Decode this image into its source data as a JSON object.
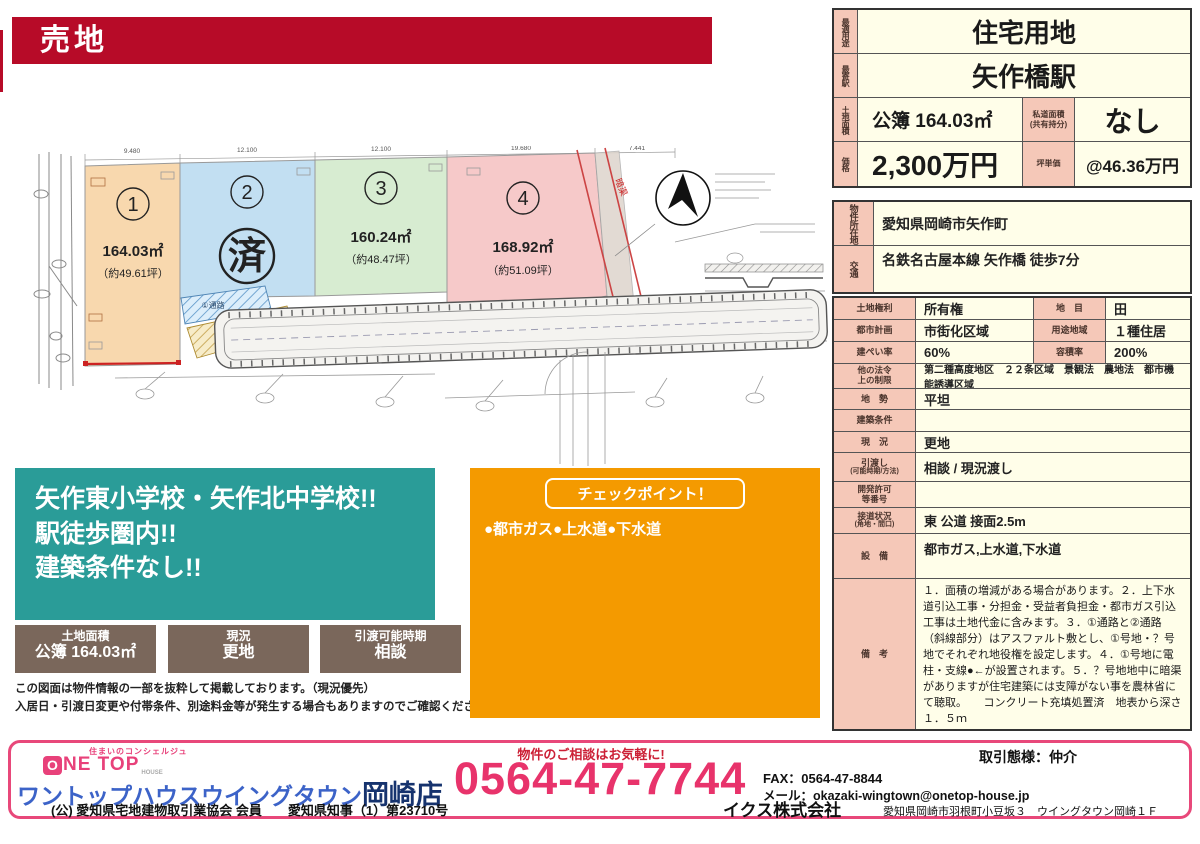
{
  "colors": {
    "banner_red": "#b70b28",
    "teal": "#2a9c98",
    "orange": "#f49a00",
    "brown": "#7a675b",
    "label_pink": "#f5c8b8",
    "cell_ivory": "#fffee9",
    "footer_pink": "#e8487a",
    "phone_pink": "#e8336b",
    "logo_blue": "#3c63c8",
    "logo_navy": "#16336e",
    "lot1": "#f8d8ae",
    "lot2": "#c2dff2",
    "lot3": "#d7ecd1",
    "lot4": "#f6c9c9"
  },
  "banner": {
    "title": "売地"
  },
  "summary": {
    "r1": {
      "label": "最適用途",
      "value": "住宅用地"
    },
    "r2": {
      "label": "最寄駅",
      "value": "矢作橋駅"
    },
    "r3": {
      "label": "土地面積",
      "value": "公簿 164.03㎡",
      "label2": "私道面積",
      "label2_sub": "(共有持分)",
      "value2": "なし"
    },
    "r4": {
      "label": "価格",
      "value": "2,300万円",
      "label2": "坪単価",
      "value2": "@46.36万円"
    }
  },
  "details": {
    "r1": {
      "label": "物件所在地",
      "value": "愛知県岡崎市矢作町"
    },
    "r2": {
      "label": "交通",
      "value": "名鉄名古屋本線 矢作橋 徒歩7分"
    },
    "r3": {
      "label": "土地権利",
      "value": "所有権",
      "label2": "地　目",
      "value2": "田"
    },
    "r4": {
      "label": "都市計画",
      "value": "市街化区域",
      "label2": "用途地域",
      "value2": "１種住居"
    },
    "r5": {
      "label": "建ぺい率",
      "value": "60%",
      "label2": "容積率",
      "value2": "200%"
    },
    "r6": {
      "label": "他の法令",
      "label_sub": "上の制限",
      "value": "第二種高度地区　２２条区域　景観法　農地法　都市機能誘導区域"
    },
    "r7": {
      "label": "地　勢",
      "value": "平坦"
    },
    "r8": {
      "label": "建築条件",
      "value": ""
    },
    "r9": {
      "label": "現　況",
      "value": "更地"
    },
    "r10": {
      "label": "引渡し",
      "label_sub": "(可能時期/方法)",
      "value": "相談 / 現況渡し"
    },
    "r11": {
      "label": "開発許可",
      "label_sub": "等番号",
      "value": ""
    },
    "r12": {
      "label": "接道状況",
      "label_sub": "(角地・間口)",
      "value": "東 公道 接面2.5m"
    },
    "r13": {
      "label": "設　備",
      "value": "都市ガス,上水道,下水道"
    },
    "r14": {
      "label": "備　考",
      "value": "１．面積の増減がある場合があります。２．上下水道引込工事・分担金・受益者負担金・都市ガス引込工事は土地代金に含みます。３．①通路と②通路（斜線部分）はアスファルト敷とし、①号地・？号地でそれぞれ地役権を設定します。４．①号地に電柱・支線●←が設置されます。５．？号地地中に暗渠がありますが住宅建築には支障がない事を農林省にて聴取。　　コンクリート充填処置済　地表から深さ１．５ｍ"
    }
  },
  "map": {
    "lots": [
      {
        "no": "1",
        "area": "164.03㎡",
        "tsubo": "（約49.61坪）"
      },
      {
        "no": "2",
        "status": "済"
      },
      {
        "no": "3",
        "area": "160.24㎡",
        "tsubo": "（約48.47坪）"
      },
      {
        "no": "4",
        "area": "168.92㎡",
        "tsubo": "（約51.09坪）"
      }
    ],
    "passages": [
      "①通路",
      "②通路"
    ],
    "dims": [
      "9.480",
      "12.100",
      "12.100",
      "19.680",
      "7.441"
    ],
    "red_note": "暗渠"
  },
  "highlight": {
    "line1": "矢作東小学校・矢作北中学校!!",
    "line2": "駅徒歩圏内!!",
    "line3": "建築条件なし!!"
  },
  "info_boxes": [
    {
      "label": "土地面積",
      "value": "公簿 164.03㎡"
    },
    {
      "label": "現況",
      "value": "更地"
    },
    {
      "label": "引渡可能時期",
      "value": "相談"
    }
  ],
  "disclaimer": {
    "line1": "この図面は物件情報の一部を抜粋して掲載しております。（現況優先）",
    "line2": "入居日・引渡日変更や付帯条件、別途料金等が発生する場合もありますのでご確認ください。"
  },
  "checkpoint": {
    "title": "チェックポイント！",
    "body": "●都市ガス●上水道●下水道"
  },
  "footer": {
    "tagline": "住まいのコンシェルジュ",
    "logo_o": "O",
    "logo_rest": "NE TOP",
    "logo_house": "HOUSE",
    "company_kana": "ワントップハウスウイングタウン",
    "branch": "岡崎店",
    "license": "(公) 愛知県宅地建物取引業協会 会員　　愛知県知事（1）第23710号",
    "contact_note": "物件のご相談はお気軽に!",
    "phone": "0564-47-7744",
    "corp": "イクス株式会社",
    "trade_type": "取引態様：仲介",
    "fax": "FAX：0564-47-8844",
    "email": "メール：okazaki-wingtown@onetop-house.jp",
    "address": "愛知県岡崎市羽根町小豆坂３　ウイングタウン岡崎１Ｆ"
  }
}
